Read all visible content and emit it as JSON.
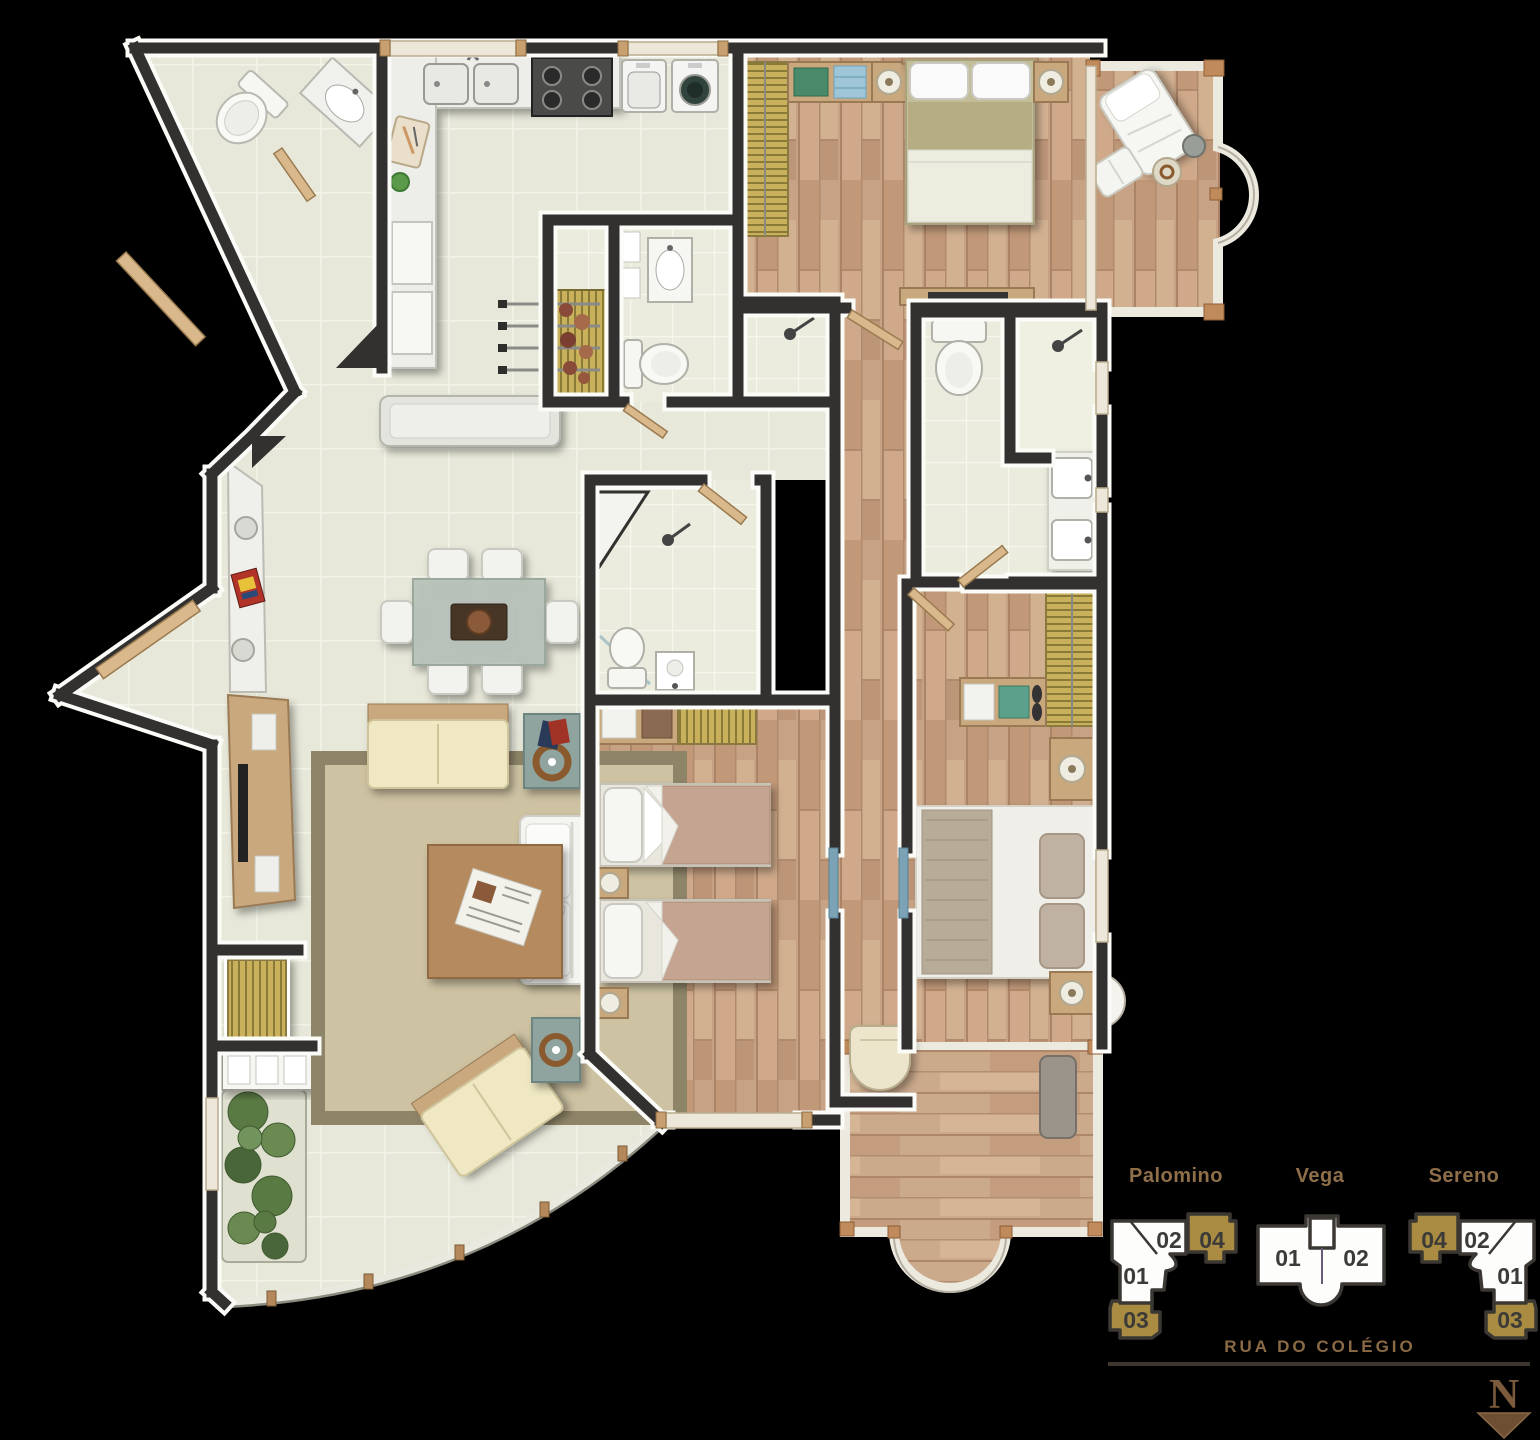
{
  "legend": {
    "buildings": [
      {
        "name": "Palomino",
        "units": [
          {
            "label": "01",
            "highlight": false
          },
          {
            "label": "02",
            "highlight": false
          },
          {
            "label": "03",
            "highlight": true
          },
          {
            "label": "04",
            "highlight": true
          }
        ]
      },
      {
        "name": "Vega",
        "units": [
          {
            "label": "01",
            "highlight": false
          },
          {
            "label": "02",
            "highlight": false
          }
        ]
      },
      {
        "name": "Sereno",
        "units": [
          {
            "label": "01",
            "highlight": false
          },
          {
            "label": "02",
            "highlight": false
          },
          {
            "label": "03",
            "highlight": true
          },
          {
            "label": "04",
            "highlight": true
          }
        ]
      }
    ],
    "street_label": "RUA DO COLÉGIO",
    "compass_letter": "N"
  },
  "colors": {
    "background": "#000000",
    "wall": "#333130",
    "wall_edge": "#fbfbf7",
    "tile_floor": "#e7e8d9",
    "bath_floor": "#ebecdd",
    "wood_floor": "#c8a284",
    "rug": "#cdc2a2",
    "rug_border": "#8e8468",
    "counter": "#ededea",
    "sofa_white": "#f4f4f1",
    "sofa_cream": "#efe8c2",
    "cabinet_wood": "#c9a87e",
    "slat_gold": "#c9b05a",
    "door_wood": "#d9b98c",
    "glass": "#a9c3cb",
    "legend_gold": "#a98c42",
    "legend_outline": "#3b3733",
    "legend_text": "#8f6f49",
    "street_text": "#8a6a45",
    "compass_brown": "#6f4f33"
  },
  "plan": {
    "rooms": [
      "entry-lavatory",
      "kitchen",
      "laundry-corner",
      "barbecue-area",
      "service-bathroom",
      "hall",
      "dining-area",
      "living-room",
      "curved-terrace",
      "master-bedroom",
      "master-balcony",
      "master-bathroom",
      "bedroom-2",
      "bedroom-2-bathroom",
      "bedroom-3",
      "bedroom-3-balcony",
      "corridor"
    ],
    "fixtures": [
      "toilet",
      "washbasin",
      "double-sink",
      "stove",
      "washer",
      "dryer",
      "barbecue-grill",
      "shower",
      "dining-table-6-chairs",
      "sideboard",
      "tv-cabinet",
      "sofa",
      "loveseat",
      "coffee-table",
      "side-table",
      "planter",
      "double-bed",
      "single-bed",
      "wardrobe",
      "nightstand-lamp",
      "lounge-chair",
      "ottoman",
      "tub-chair",
      "bench"
    ]
  }
}
